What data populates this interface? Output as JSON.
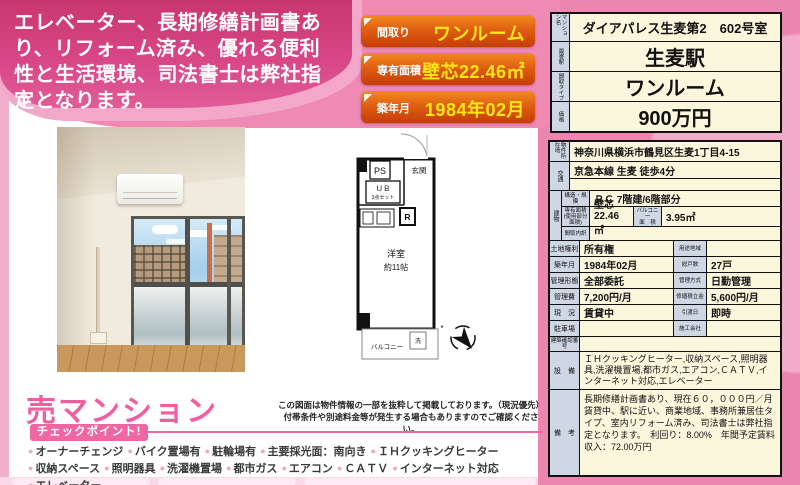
{
  "headline": {
    "text": "エレベーター、長期修繕計画書あり、リフォーム済み、優れる便利性と生活環境、司法書士は弊社指定となります。"
  },
  "ribbons": {
    "madori_label": "間取り",
    "madori_value": "ワンルーム",
    "menseki_label": "専有面積",
    "menseki_value": "壁芯22.46㎡",
    "chiku_label": "築年月",
    "chiku_value": "1984年02月"
  },
  "summary": {
    "name_label": "マンション名",
    "name_value": "ダイアパレス生麦第2　602号室",
    "station_label": "最寄駅",
    "station_value": "生麦駅",
    "type_label": "間取タイプ",
    "type_value": "ワンルーム",
    "price_label": "価格",
    "price_value": "900万円"
  },
  "detail": {
    "address_label": "物件所在地",
    "address": "神奈川県横浜市鶴見区生麦1丁目4-15",
    "access_label": "交通",
    "access": "京急本線 生麦 徒歩4分",
    "access2": "",
    "building_label": "建物",
    "structure_label": "構造・規模",
    "structure": "ＲＣ 7階建/6階部分",
    "area_label": "専有面積",
    "area_sublabel": "(使用部分面積)",
    "area": "壁芯22.46㎡",
    "balcony_label": "バルコニー",
    "balcony_label2": "面　積",
    "balcony": "3.95㎡",
    "layout_label": "間取内訳",
    "layout": "",
    "rows": [
      {
        "l1": "土地権利",
        "v1": "所有権",
        "l2": "用途地域",
        "v2": ""
      },
      {
        "l1": "築年月",
        "v1": "1984年02月",
        "l2": "総戸数",
        "v2": "27戸"
      },
      {
        "l1": "管理形態",
        "v1": "全部委託",
        "l2": "管理方式",
        "v2": "日勤管理"
      },
      {
        "l1": "管理費",
        "v1": "7,200円/月",
        "l2": "修繕積立金",
        "v2": "5,600円/月"
      },
      {
        "l1": "現　況",
        "v1": "賃貸中",
        "l2": "引渡日",
        "v2": "即時"
      },
      {
        "l1": "駐車場",
        "v1": "",
        "l2": "施工会社",
        "v2": ""
      }
    ],
    "confirm_label": "建築確認番号",
    "confirm": "",
    "equipment_label": "設　備",
    "equipment": "ＩＨクッキングヒーター,収納スペース,照明器具,洗濯機置場,都市ガス,エアコン,ＣＡＴＶ,インターネット対応,エレベーター",
    "notes_label": "備　考",
    "notes": "長期修繕計画書あり、現在６０，０００円／月賃貸中、駅に近い、商業地域、事務所兼居住タイプ、室内リフォーム済み、司法書士は弊社指定となります。　利回り：8.00%　年間予定賃料収入：72.00万円"
  },
  "floorplan": {
    "ps": "PS",
    "entrance": "玄関",
    "ub": "ＵＢ",
    "ub_sub": "3点セット",
    "fridge": "R",
    "room": "洋室",
    "room_size": "約11帖",
    "balcony": "バルコニー",
    "washer": "洗",
    "mark": "*"
  },
  "disclaimer": {
    "line1": "この図面は物件情報の一部を抜粋して掲載しております。（現況優先）",
    "line2": "付帯条件や別途料金等が発生する場合もありますのでご確認ください。"
  },
  "sale": {
    "title": "売マンション",
    "badge": "チェックポイント!",
    "checkpoints": [
      "オーナーチェンジ",
      "バイク置場有",
      "駐輪場有",
      "主要採光面：南向き",
      "ＩＨクッキングヒーター",
      "収納スペース",
      "照明器具",
      "洗濯機置場",
      "都市ガス",
      "エアコン",
      "ＣＡＴＶ",
      "インターネット対応",
      "エレベーター"
    ]
  },
  "colors": {
    "deep_pink": "#d84687",
    "bg_pink": "#ee8ab3",
    "light_pink": "#f3a8ca",
    "accent_pink": "#ef5fa0",
    "ribbon_orange": "#e05f12",
    "ribbon_yellow": "#ffe816",
    "table_cream": "#fbf7dd",
    "table_label_blue": "#cfd7e4"
  }
}
